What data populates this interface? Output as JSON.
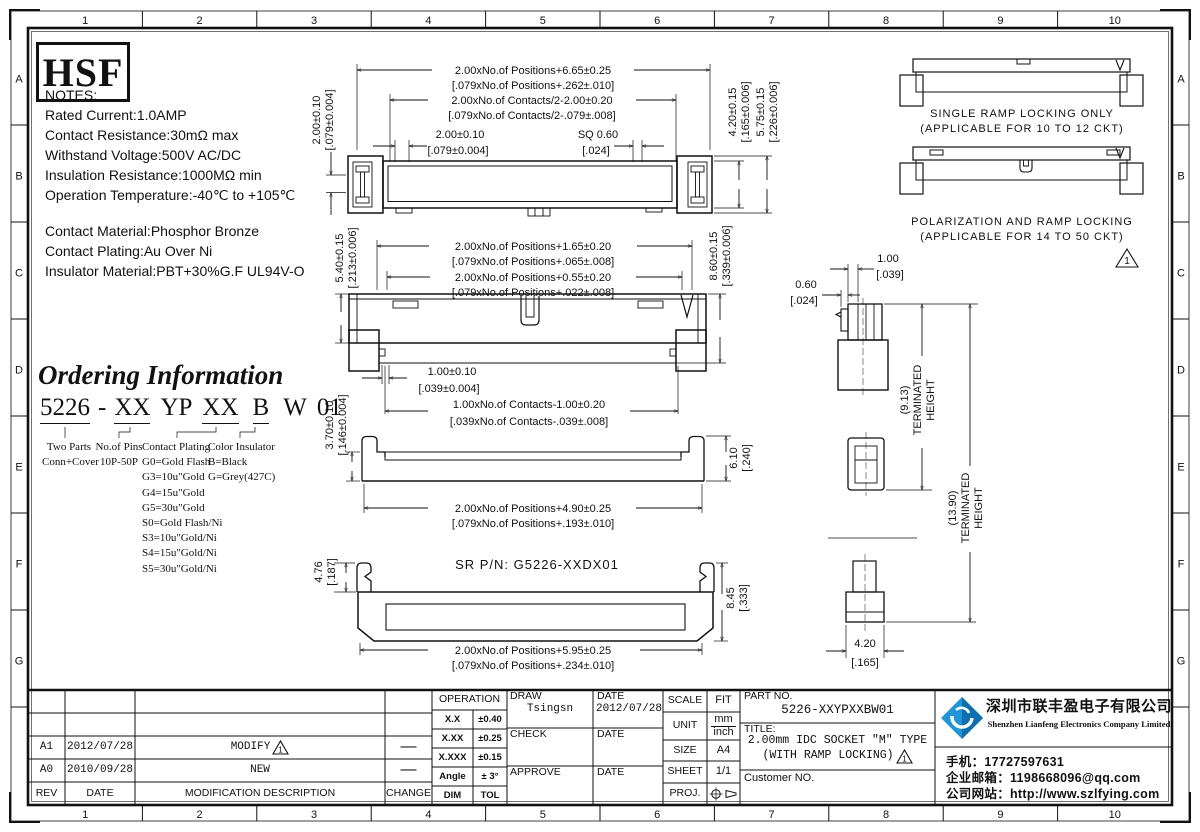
{
  "page": {
    "cols": [
      "1",
      "2",
      "3",
      "4",
      "5",
      "6",
      "7",
      "8",
      "9",
      "10"
    ],
    "rows": [
      "A",
      "B",
      "C",
      "D",
      "E",
      "F",
      "G"
    ]
  },
  "logo_text": "HSF",
  "notes": {
    "title": "NOTES:",
    "lines": [
      "Rated Current:1.0AMP",
      "Contact Resistance:30mΩ max",
      "Withstand Voltage:500V AC/DC",
      "Insulation Resistance:1000MΩ min",
      "Operation Temperature:-40℃ to +105℃"
    ],
    "materials": [
      "Contact Material:Phosphor Bronze",
      "Contact Plating:Au Over Ni",
      "Insulator Material:PBT+30%G.F UL94V-O"
    ]
  },
  "ordering": {
    "title": "Ordering Information",
    "p1": "5226",
    "p2": "-",
    "p3": "XX",
    "p4": "YP",
    "p5": "XX",
    "p6": "B",
    "p7": "W",
    "p8": "01",
    "col1_line1": "Two Parts",
    "col1_line2": "Conn+Cover",
    "col2_line1": "No.of Pins",
    "col2_line2": "10P-50P",
    "col3_title": "Contact Plating",
    "col3_items": [
      "G0=Gold Flash",
      "G3=10u\"Gold",
      "G4=15u\"Gold",
      "G5=30u\"Gold",
      "S0=Gold Flash/Ni",
      "S3=10u\"Gold/Ni",
      "S4=15u\"Gold/Ni",
      "S5=30u\"Gold/Ni"
    ],
    "col4_title": "Color Insulator",
    "col4_items": [
      "B=Black",
      "G=Grey(427C)"
    ]
  },
  "dims": {
    "tv_pos_mm": "2.00xNo.of Positions+6.65±0.25",
    "tv_pos_in": "[.079xNo.of Positions+.262±.010]",
    "tv_cont_mm": "2.00xNo.of Contacts/2-2.00±0.20",
    "tv_cont_in": "[.079xNo.of Contacts/2-.079±.008]",
    "tv_pitch_mm": "2.00±0.10",
    "tv_pitch_in": "[.079±0.004]",
    "tv_sq_mm": "SQ 0.60",
    "tv_sq_in": "[.024]",
    "tv_row_mm": "2.00±0.10",
    "tv_row_in": "[.079±0.004]",
    "tv_h1_mm": "4.20±0.15",
    "tv_h1_in": "[.165±0.006]",
    "tv_h2_mm": "5.75±0.15",
    "tv_h2_in": "[.226±0.006]",
    "fv_pos1_mm": "2.00xNo.of Positions+1.65±0.20",
    "fv_pos1_in": "[.079xNo.of Positions+.065±.008]",
    "fv_pos2_mm": "2.00xNo.of Positions+0.55±0.20",
    "fv_pos2_in": "[.079xNo.of Positions+.022±.008]",
    "fv_h1_mm": "5.40±0.15",
    "fv_h1_in": "[.213±0.006]",
    "fv_h2_mm": "8.60±0.15",
    "fv_h2_in": "[.339±0.006]",
    "fv_pitch_mm": "1.00±0.10",
    "fv_pitch_in": "[.039±0.004]",
    "fv_cont_mm": "1.00xNo.of Contacts-1.00±0.20",
    "fv_cont_in": "[.039xNo.of Contacts-.039±.008]",
    "fv_h3_mm": "3.70±0.10",
    "fv_h3_in": "[.146±0.004]",
    "bv_pos_mm": "2.00xNo.of Positions+4.90±0.25",
    "bv_pos_in": "[.079xNo.of Positions+.193±.010]",
    "bv_h_mm": "6.10",
    "bv_h_in": "[.240]",
    "sr_label": "SR P/N: G5226-XXDX01",
    "sr_h1_mm": "4.76",
    "sr_h1_in": "[.187]",
    "sr_h2_mm": "8.45",
    "sr_h2_in": "[.333]",
    "sr_pos_mm": "2.00xNo.of Positions+5.95±0.25",
    "sr_pos_in": "[.079xNo.of Positions+.234±.010]",
    "sv_p1_mm": "1.00",
    "sv_p1_in": "[.039]",
    "sv_p2_mm": "0.60",
    "sv_p2_in": "[.024]",
    "sv_th1": "(9.13)",
    "sv_th2": "(13.90)",
    "sv_term": "TERMINATED",
    "sv_height": "HEIGHT",
    "sv_w_mm": "4.20",
    "sv_w_in": "[.165]"
  },
  "ramp": {
    "single1": "SINGLE RAMP LOCKING ONLY",
    "single2": "(APPLICABLE FOR 10 TO 12 CKT)",
    "polar1": "POLARIZATION AND RAMP LOCKING",
    "polar2": "(APPLICABLE FOR 14 TO 50 CKT)"
  },
  "titleblock": {
    "rev_mark": "1",
    "revisions": [
      {
        "rev": "A1",
        "date": "2012/07/28",
        "desc": "MODIFY",
        "change": "—"
      },
      {
        "rev": "A0",
        "date": "2010/09/28",
        "desc": "NEW",
        "change": "—"
      }
    ],
    "rev_header": {
      "rev": "REV",
      "date": "DATE",
      "desc": "MODIFICATION  DESCRIPTION",
      "change": "CHANGE"
    },
    "operation": {
      "title": "OPERATION",
      "rows": [
        [
          "X.X",
          "±0.40"
        ],
        [
          "X.XX",
          "±0.25"
        ],
        [
          "X.XXX",
          "±0.15"
        ],
        [
          "Angle",
          "± 3°"
        ],
        [
          "DIM",
          "TOL"
        ]
      ]
    },
    "sign": {
      "draw": "DRAW",
      "draw_name": "Tsingsn",
      "date": "DATE",
      "draw_date": "2012/07/28",
      "check": "CHECK",
      "approve": "APPROVE"
    },
    "meta": {
      "scale": "SCALE",
      "scale_v": "FIT",
      "unit": "UNIT",
      "unit_mm": "mm",
      "unit_in": "inch",
      "size": "SIZE",
      "size_v": "A4",
      "sheet": "SHEET",
      "sheet_v": "1/1",
      "proj": "PROJ."
    },
    "part": {
      "label": "PART NO.",
      "number": "5226-XXYPXXBW01",
      "title_label": "TITLE:",
      "title1": "2.00mm IDC SOCKET \"M\" TYPE",
      "title2": "(WITH RAMP LOCKING)",
      "customer": "Customer NO."
    }
  },
  "company": {
    "cn": "深圳市联丰盈电子有限公司",
    "en": "Shenzhen Lianfeng Electronics Company Limited",
    "phone": "手机：17727597631",
    "email": "企业邮箱：1198668096@qq.com",
    "web": "公司网站：http://www.szlfying.com"
  },
  "colors": {
    "line": "#111111",
    "logo_blue_dark": "#0d6fae",
    "logo_blue_light": "#2196d6"
  }
}
